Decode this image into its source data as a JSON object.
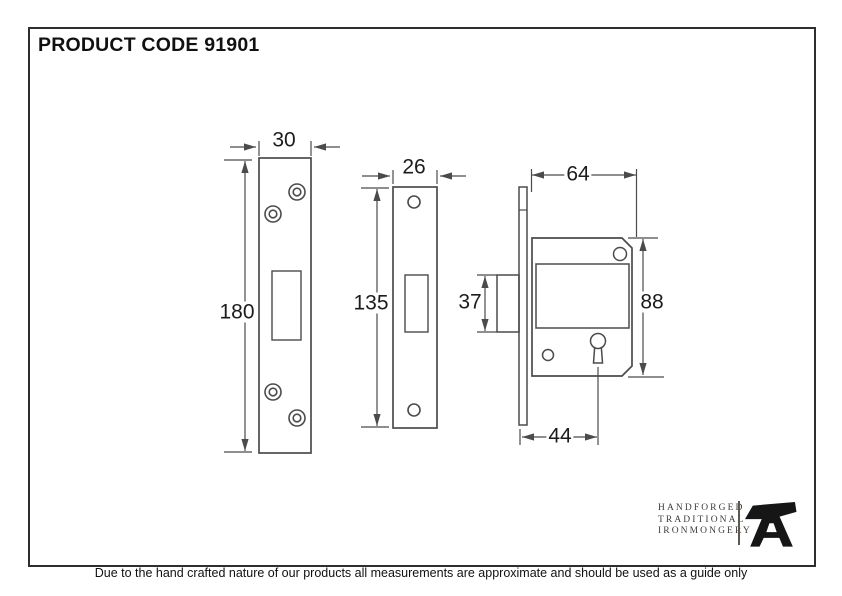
{
  "header": {
    "product_code": "PRODUCT CODE 91901"
  },
  "diagram": {
    "strike_plate": {
      "width_mm": "30",
      "height_mm": "180"
    },
    "faceplate": {
      "width_mm": "26",
      "height_mm": "135"
    },
    "lock_body": {
      "width_mm": "64",
      "height_mm": "88",
      "bolt_height_mm": "37",
      "keyhole_backset_mm": "44"
    }
  },
  "logo": {
    "lines": [
      "HANDFORGED",
      "TRADITIONAL",
      "IRONMONGERY"
    ],
    "icon": "anvil-icon"
  },
  "footer": {
    "disclaimer": "Due to the hand crafted nature of our products all measurements are approximate and should be used as a guide only"
  },
  "colors": {
    "line": "#4b4b4b",
    "text": "#1c1c1c",
    "background": "#ffffff"
  }
}
